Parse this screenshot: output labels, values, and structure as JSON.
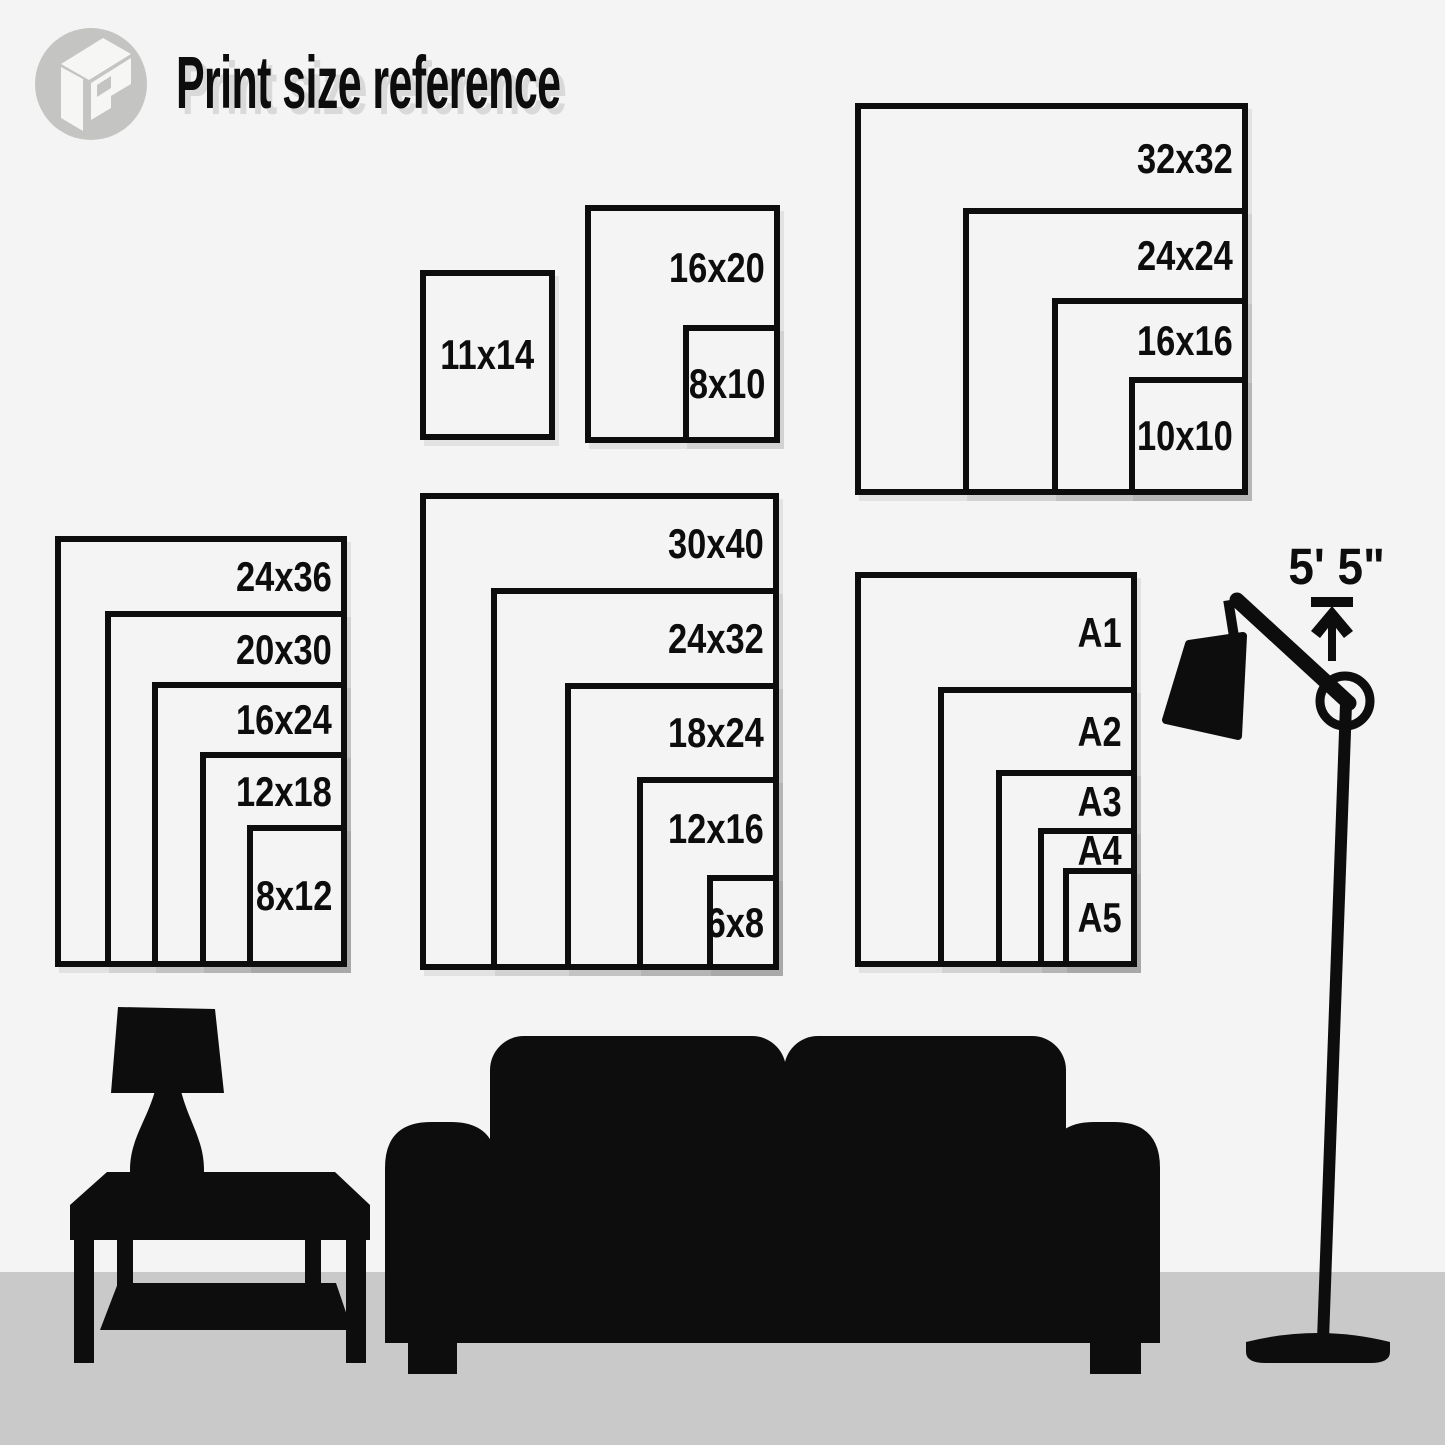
{
  "header": {
    "title": "Print size reference"
  },
  "icons": {
    "logo": "brand-logo-icon",
    "height_arrow": "arrow-up-icon"
  },
  "groups": [
    {
      "name": "portrait-small",
      "sizes": [
        "11x14"
      ]
    },
    {
      "name": "portrait-medium",
      "sizes": [
        "16x20",
        "8x10"
      ]
    },
    {
      "name": "square",
      "sizes": [
        "32x32",
        "24x24",
        "16x16",
        "10x10"
      ]
    },
    {
      "name": "portrait-left",
      "sizes": [
        "24x36",
        "20x30",
        "16x24",
        "12x18",
        "8x12"
      ]
    },
    {
      "name": "portrait-center",
      "sizes": [
        "30x40",
        "24x32",
        "18x24",
        "12x16",
        "6x8"
      ]
    },
    {
      "name": "a-series",
      "sizes": [
        "A1",
        "A2",
        "A3",
        "A4",
        "A5"
      ]
    }
  ],
  "height_marker": {
    "label": "5' 5\""
  },
  "scene": {
    "items": [
      "table-lamp",
      "coffee-table",
      "sofa",
      "floor-lamp"
    ]
  },
  "colors": {
    "wall": "#f4f4f4",
    "floor": "#c9c9c9",
    "ink": "#0d0d0d",
    "logo_gray": "#c4c4c2",
    "logo_mark": "#f6f6f5",
    "shadow": "#d9d9d9"
  }
}
